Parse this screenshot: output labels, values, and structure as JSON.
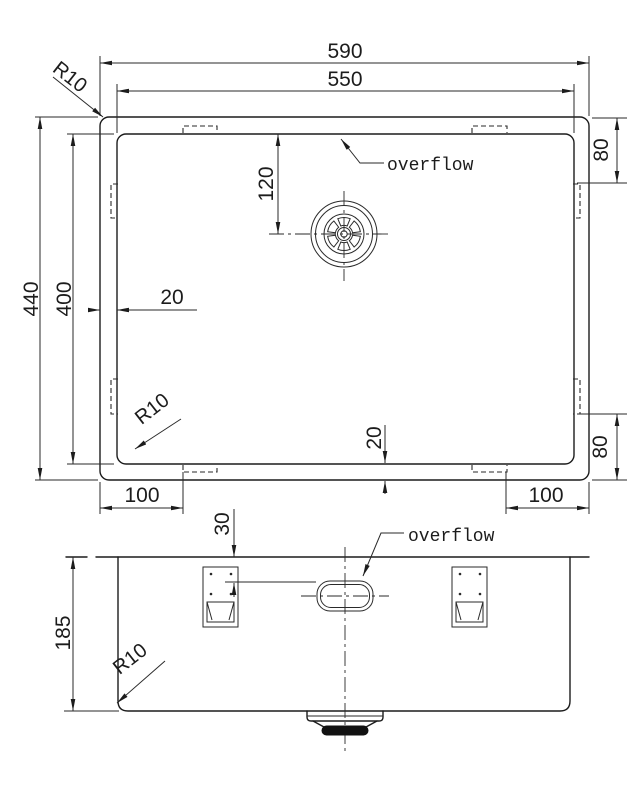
{
  "meta": {
    "background": "#ffffff",
    "line_color": "#1c1c1c",
    "drawing_type": "sink technical drawing, top view and front elevation"
  },
  "top_view": {
    "dim_outer_width": "590",
    "dim_inner_width": "550",
    "dim_outer_height": "440",
    "dim_inner_height": "400",
    "dim_drain_from_top": "120",
    "dim_rim_left": "20",
    "dim_rim_bottom": "20",
    "dim_clip_top_right": "80",
    "dim_clip_bottom_right": "80",
    "dim_clip_bottom_left": "100",
    "dim_clip_bottom_right_h": "100",
    "corner_radius_top_left": "R10",
    "corner_radius_bottom_left": "R10",
    "overflow_label": "overflow"
  },
  "front_view": {
    "dim_height": "185",
    "dim_overflow_from_top": "30",
    "corner_radius": "R10",
    "overflow_label": "overflow"
  }
}
